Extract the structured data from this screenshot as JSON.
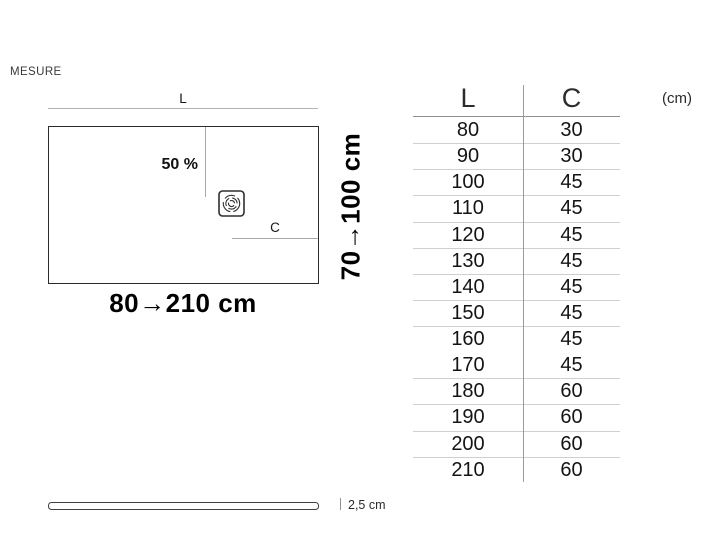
{
  "header": {
    "label": "MESURE"
  },
  "diagram": {
    "length_dim_label": "L",
    "slope_label": "50 %",
    "drain_dim_label": "C",
    "length_range_label": "80→210 cm",
    "depth_range_label": "70→100 cm"
  },
  "size_table": {
    "columns": [
      "L",
      "C"
    ],
    "unit_label": "(cm)",
    "rows": [
      {
        "L": "80",
        "C": "30"
      },
      {
        "L": "90",
        "C": "30"
      },
      {
        "L": "100",
        "C": "45"
      },
      {
        "L": "110",
        "C": "45"
      },
      {
        "L": "120",
        "C": "45"
      },
      {
        "L": "130",
        "C": "45"
      },
      {
        "L": "140",
        "C": "45"
      },
      {
        "L": "150",
        "C": "45"
      },
      {
        "L": "160",
        "C": "45"
      },
      {
        "L": "170",
        "C": "45"
      },
      {
        "L": "180",
        "C": "60"
      },
      {
        "L": "190",
        "C": "60"
      },
      {
        "L": "200",
        "C": "60"
      },
      {
        "L": "210",
        "C": "60"
      }
    ],
    "no_separator_rows": [
      9
    ]
  },
  "profile": {
    "thickness_label": "2,5 cm"
  },
  "colors": {
    "line_gray": "#b3b3b3",
    "rect_border": "#2b2b2b",
    "row_separator": "#cfcfcf",
    "text_black": "#141414"
  }
}
